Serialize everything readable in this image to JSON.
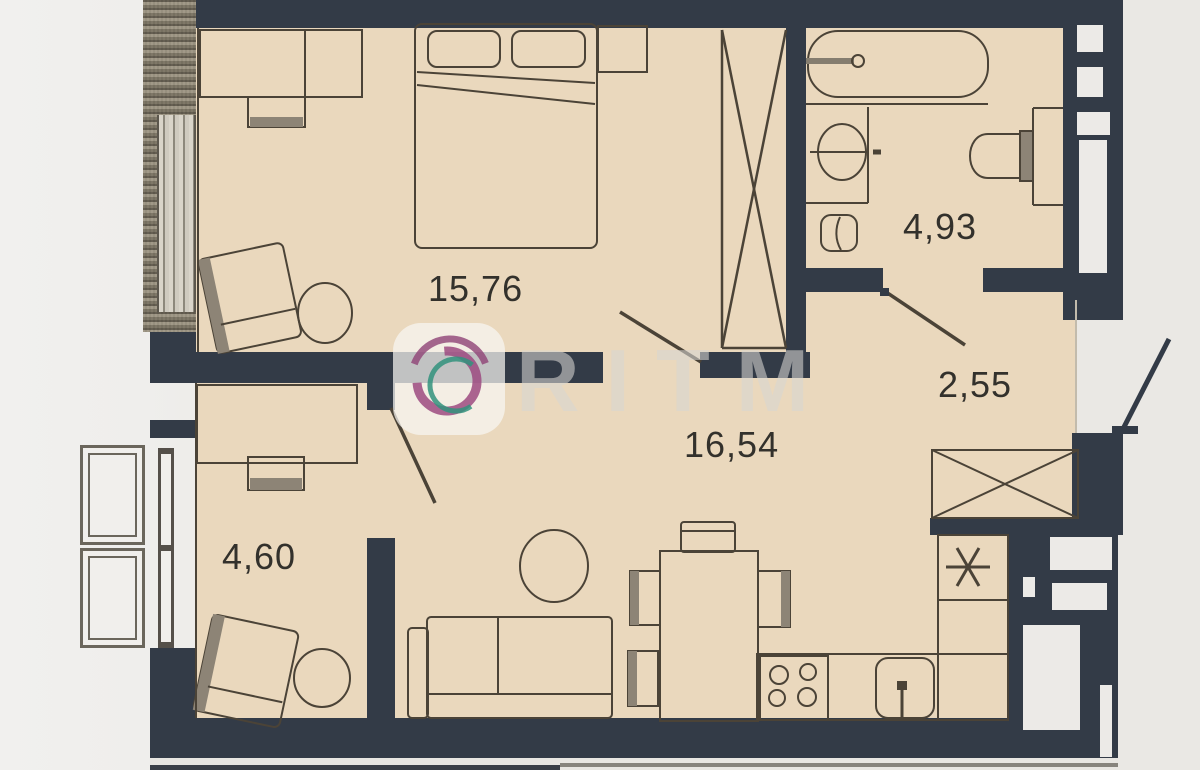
{
  "watermark": {
    "brand": "RITM",
    "icon": "ritm-swirl-logo"
  },
  "rooms": [
    {
      "name": "bedroom",
      "area_label": "15,76"
    },
    {
      "name": "bathroom",
      "area_label": "4,93"
    },
    {
      "name": "hallway",
      "area_label": "2,55"
    },
    {
      "name": "living-kitchen",
      "area_label": "16,54"
    },
    {
      "name": "cabinet-room",
      "area_label": "4,60"
    }
  ],
  "colors": {
    "wall": "#333B47",
    "floor": "#EAD8BD",
    "background": "#ECEAE7",
    "furniture_line": "#4B4337",
    "logo_magenta": "#9C4A80",
    "logo_teal": "#31927C"
  },
  "icons": {
    "wardrobe": "crossed-box",
    "hall_cabinet": "crossed-box",
    "fridge": "asterisk-mark",
    "entry_door": "door-swing",
    "fixtures": [
      "bathtub",
      "sink",
      "washing-machine",
      "toilet",
      "stove-4-burner",
      "kitchen-sink"
    ]
  }
}
